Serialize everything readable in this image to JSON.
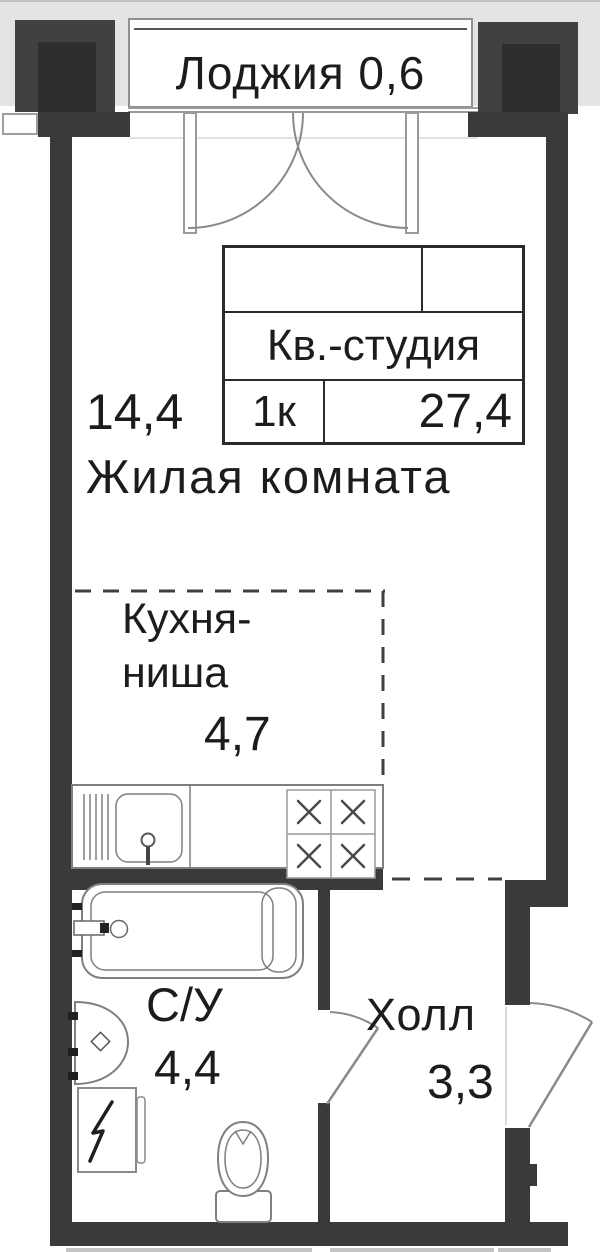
{
  "loggia": {
    "label": "Лоджия 0,6"
  },
  "stamp": {
    "name": "Кв.-студия",
    "rooms": "1к",
    "area": "27,4"
  },
  "rooms": {
    "living": {
      "area": "14,4",
      "label": "Жилая комната"
    },
    "kitchen": {
      "line1": "Кухня-",
      "line2": "ниша",
      "area": "4,7"
    },
    "bathroom": {
      "label": "С/У",
      "area": "4,4"
    },
    "hall": {
      "label": "Холл",
      "area": "3,3"
    }
  },
  "colors": {
    "wall": "#3a3a3a",
    "wall-inner": "#2e2e2e",
    "text": "#1c1c1c",
    "fixture": "#7f7f7f",
    "door": "#8a8a8a",
    "dash": "#3f3f3f",
    "loggia-bg": "#e4e4e4",
    "frame": "#9a9a9a"
  }
}
